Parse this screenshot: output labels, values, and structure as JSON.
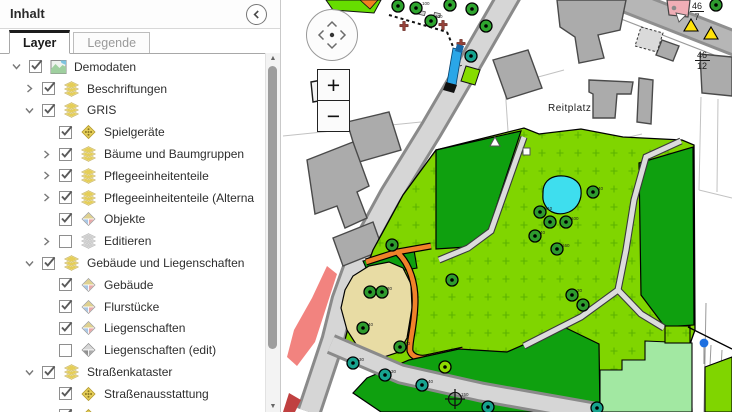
{
  "panel": {
    "title": "Inhalt",
    "tabs": [
      {
        "label": "Layer",
        "active": true
      },
      {
        "label": "Legende",
        "active": false
      }
    ],
    "tree": [
      {
        "label": "Demodaten",
        "level": 0,
        "chevron": "down",
        "checked": true,
        "icon": "map-thumb"
      },
      {
        "label": "Beschriftungen",
        "level": 1,
        "chevron": "right",
        "checked": true,
        "icon": "layers"
      },
      {
        "label": "GRIS",
        "level": 1,
        "chevron": "down",
        "checked": true,
        "icon": "layers"
      },
      {
        "label": "Spielgeräte",
        "level": 2,
        "chevron": "none",
        "checked": true,
        "icon": "diamond-dots"
      },
      {
        "label": "Bäume und Baumgruppen",
        "level": 2,
        "chevron": "right",
        "checked": true,
        "icon": "layers"
      },
      {
        "label": "Pflegeeinheitenteile",
        "level": 2,
        "chevron": "right",
        "checked": true,
        "icon": "layers"
      },
      {
        "label": "Pflegeeinheitenteile (Alterna",
        "level": 2,
        "chevron": "right",
        "checked": true,
        "icon": "layers"
      },
      {
        "label": "Objekte",
        "level": 2,
        "chevron": "none",
        "checked": true,
        "icon": "diamond-multi"
      },
      {
        "label": "Editieren",
        "level": 2,
        "chevron": "right",
        "checked": false,
        "icon": "layers-gray"
      },
      {
        "label": "Gebäude und Liegenschaften",
        "level": 1,
        "chevron": "down",
        "checked": true,
        "icon": "layers"
      },
      {
        "label": "Gebäude",
        "level": 2,
        "chevron": "none",
        "checked": true,
        "icon": "diamond-multi"
      },
      {
        "label": "Flurstücke",
        "level": 2,
        "chevron": "none",
        "checked": true,
        "icon": "diamond-multi"
      },
      {
        "label": "Liegenschaften",
        "level": 2,
        "chevron": "none",
        "checked": true,
        "icon": "diamond-multi"
      },
      {
        "label": "Liegenschaften (edit)",
        "level": 2,
        "chevron": "none",
        "checked": false,
        "icon": "diamond-gray"
      },
      {
        "label": "Straßenkataster",
        "level": 1,
        "chevron": "down",
        "checked": true,
        "icon": "layers"
      },
      {
        "label": "Straßenausstattung",
        "level": 2,
        "chevron": "none",
        "checked": true,
        "icon": "diamond-dots"
      },
      {
        "label": "",
        "level": 2,
        "chevron": "none",
        "checked": true,
        "icon": "diamond-dots"
      }
    ]
  },
  "map": {
    "controls": {
      "zoom_in": "+",
      "zoom_out": "−"
    },
    "labels": {
      "reitplatz": "Reitplatz",
      "parcel1_num": "46",
      "parcel1_den": "7",
      "parcel2_num": "46",
      "parcel2_den": "12"
    },
    "tree_numbers": [
      "100",
      "100",
      "40",
      "110",
      "100",
      "40",
      "160",
      "20",
      "30",
      "40",
      "30",
      "30",
      "30",
      "40",
      "150"
    ],
    "colors": {
      "lawn": "#80D500",
      "dense_green": "#0FA00F",
      "mint": "#A2E8A2",
      "pond": "#3EDEEE",
      "sand": "#E8DCA4",
      "path_orange": "#F0822A",
      "rose_strip": "#F2837F",
      "road": "#D6D6D6",
      "building": "#ABABAB",
      "pink_building": "#F0AEB6",
      "warning_yellow": "#FFE20A",
      "tree_green": "#2E9B2E",
      "tree_teal": "#17A38F",
      "vehicle_blue": "#2AA6E8",
      "point_blue": "#1D6FE0"
    }
  }
}
